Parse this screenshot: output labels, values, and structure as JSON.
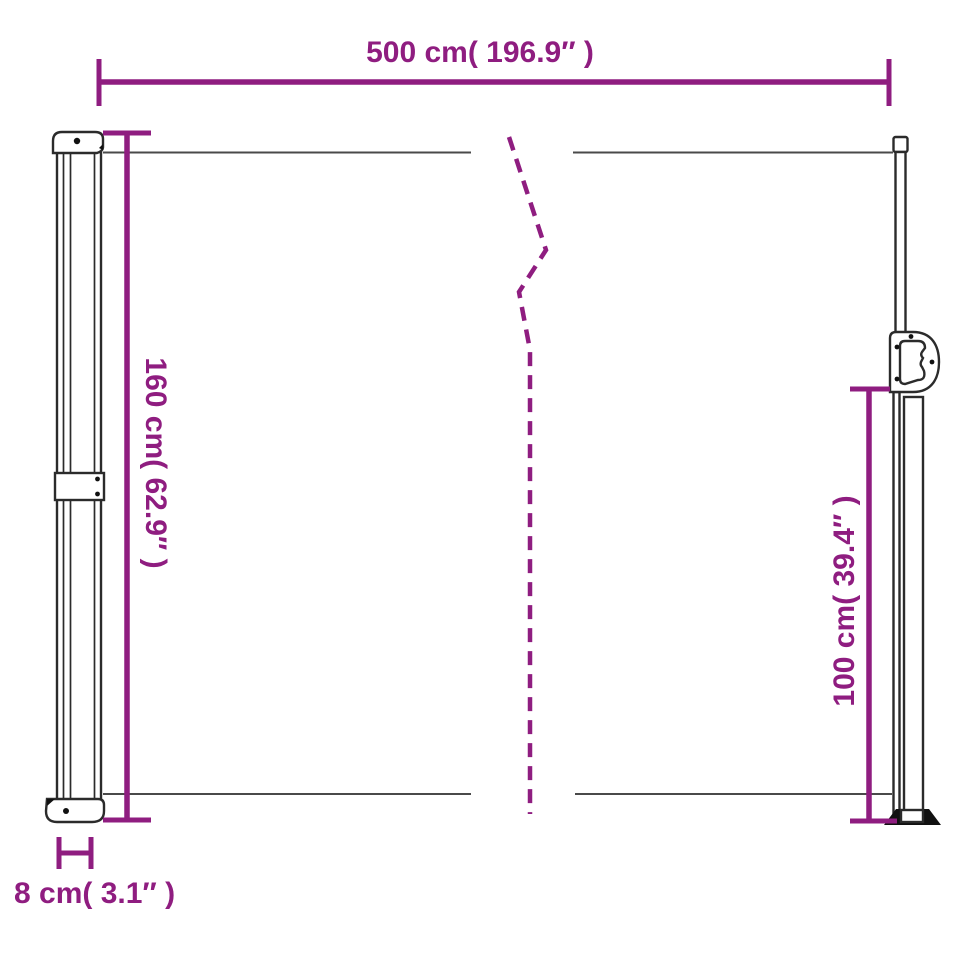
{
  "diagram": {
    "type": "product-dimension-diagram",
    "subject": "retractable-side-awning",
    "accent_color": "#8F1D80",
    "outline_color": "#2b2b2b",
    "edge_line_color": "#4a4a4a",
    "background_color": "#ffffff",
    "dimensions": {
      "width": {
        "label": "500 cm( 196.9″ )",
        "cm": 500,
        "inches": 196.9
      },
      "left_height": {
        "label": "160 cm( 62.9″ )",
        "cm": 160,
        "inches": 62.9
      },
      "right_height": {
        "label": "100 cm( 39.4″ )",
        "cm": 100,
        "inches": 39.4
      },
      "pole_depth": {
        "label": "8 cm( 3.1″ )",
        "cm": 8,
        "inches": 3.1
      }
    }
  }
}
